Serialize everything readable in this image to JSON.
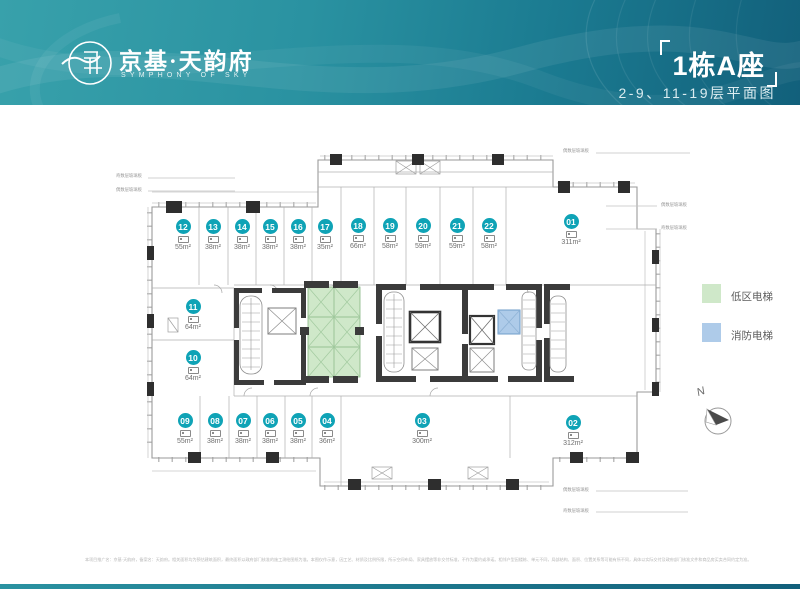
{
  "header": {
    "brand": {
      "name": "京基·天韵府",
      "tagline": "SYMPHONY OF SKY"
    },
    "title": "1栋A座",
    "subtitle": "2-9、11-19层平面图"
  },
  "plan": {
    "units": [
      {
        "id": "12",
        "area": "55m²",
        "cx": 183,
        "cy": 219
      },
      {
        "id": "13",
        "area": "38m²",
        "cx": 213,
        "cy": 219
      },
      {
        "id": "14",
        "area": "38m²",
        "cx": 242,
        "cy": 219
      },
      {
        "id": "15",
        "area": "38m²",
        "cx": 270,
        "cy": 219
      },
      {
        "id": "16",
        "area": "38m²",
        "cx": 298,
        "cy": 219
      },
      {
        "id": "17",
        "area": "35m²",
        "cx": 325,
        "cy": 219
      },
      {
        "id": "18",
        "area": "66m²",
        "cx": 358,
        "cy": 218
      },
      {
        "id": "19",
        "area": "58m²",
        "cx": 390,
        "cy": 218
      },
      {
        "id": "20",
        "area": "59m²",
        "cx": 423,
        "cy": 218
      },
      {
        "id": "21",
        "area": "59m²",
        "cx": 457,
        "cy": 218
      },
      {
        "id": "22",
        "area": "58m²",
        "cx": 489,
        "cy": 218
      },
      {
        "id": "01",
        "area": "311m²",
        "cx": 571,
        "cy": 214
      },
      {
        "id": "11",
        "area": "64m²",
        "cx": 193,
        "cy": 299
      },
      {
        "id": "10",
        "area": "64m²",
        "cx": 193,
        "cy": 350
      },
      {
        "id": "09",
        "area": "55m²",
        "cx": 185,
        "cy": 413
      },
      {
        "id": "08",
        "area": "38m²",
        "cx": 215,
        "cy": 413
      },
      {
        "id": "07",
        "area": "38m²",
        "cx": 243,
        "cy": 413
      },
      {
        "id": "06",
        "area": "38m²",
        "cx": 270,
        "cy": 413
      },
      {
        "id": "05",
        "area": "38m²",
        "cx": 298,
        "cy": 413
      },
      {
        "id": "04",
        "area": "36m²",
        "cx": 327,
        "cy": 413
      },
      {
        "id": "03",
        "area": "300m²",
        "cx": 422,
        "cy": 413
      },
      {
        "id": "02",
        "area": "312m²",
        "cx": 573,
        "cy": 415
      }
    ],
    "unit_marker_icon": "bed",
    "facade_labels": [
      {
        "text": "奇数层玻璃板",
        "x": 116,
        "y": 172
      },
      {
        "text": "偶数层玻璃板",
        "x": 116,
        "y": 186
      },
      {
        "text": "偶数层玻璃板",
        "x": 661,
        "y": 201
      },
      {
        "text": "奇数层玻璃板",
        "x": 661,
        "y": 224
      },
      {
        "text": "偶数层玻璃板",
        "x": 563,
        "y": 147
      },
      {
        "text": "偶数层玻璃板",
        "x": 563,
        "y": 486
      },
      {
        "text": "奇数层玻璃板",
        "x": 563,
        "y": 507
      }
    ],
    "colors": {
      "low_zone_elevator": "#cfe8c9",
      "fire_elevator": "#aecbe9",
      "unit_badge": "#0fa3b6",
      "wall": "#3b3b3b",
      "header_teal": "#1b7b91"
    }
  },
  "legend": {
    "items": [
      {
        "label": "低区电梯",
        "color": "#cfe8c9"
      },
      {
        "label": "消防电梯",
        "color": "#aecbe9"
      }
    ]
  },
  "compass": {
    "label": "N"
  },
  "footer": {
    "disclaimer": "本项目推广名：京基·天韵府，备案名：天韵府。相关面积均为预估建筑面积，最终面积以政府部门核准的施工测绘图纸为准。本图仅作示意，因工艺、材质及比例所限，所示空间布局、家具摆放等非交付标准，不作为要约或承诺。相邻户型因楼栋、单元不同，局部结构、面积、位置关系等可能有所不同，具体以实际交付及政府部门核准文件和商品房买卖合同约定为准。"
  }
}
